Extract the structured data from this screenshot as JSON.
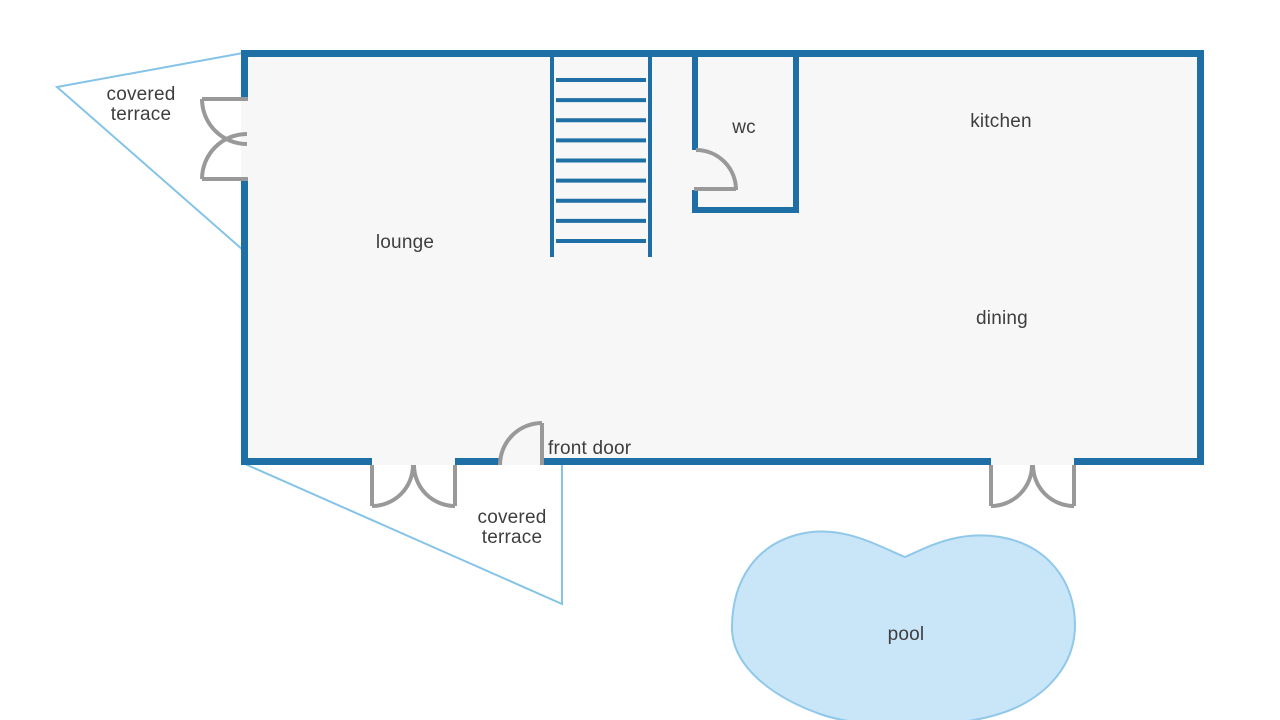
{
  "labels": {
    "terrace_nw": {
      "line1": "covered",
      "line2": "terrace"
    },
    "lounge": "lounge",
    "wc": "wc",
    "kitchen": "kitchen",
    "dining": "dining",
    "front_door": "front door",
    "terrace_s": {
      "line1": "covered",
      "line2": "terrace"
    },
    "pool": "pool"
  },
  "stairs": {
    "steps": 9
  },
  "colors": {
    "wall": "#1e6fa5",
    "terrace-line": "#85c3e8",
    "pool-fill": "#c9e5f8",
    "pool-stroke": "#90c8ea",
    "floor-fill": "#f7f7f7",
    "door": "#999999",
    "label": "#3e3e3e",
    "background": "#ffffff"
  }
}
